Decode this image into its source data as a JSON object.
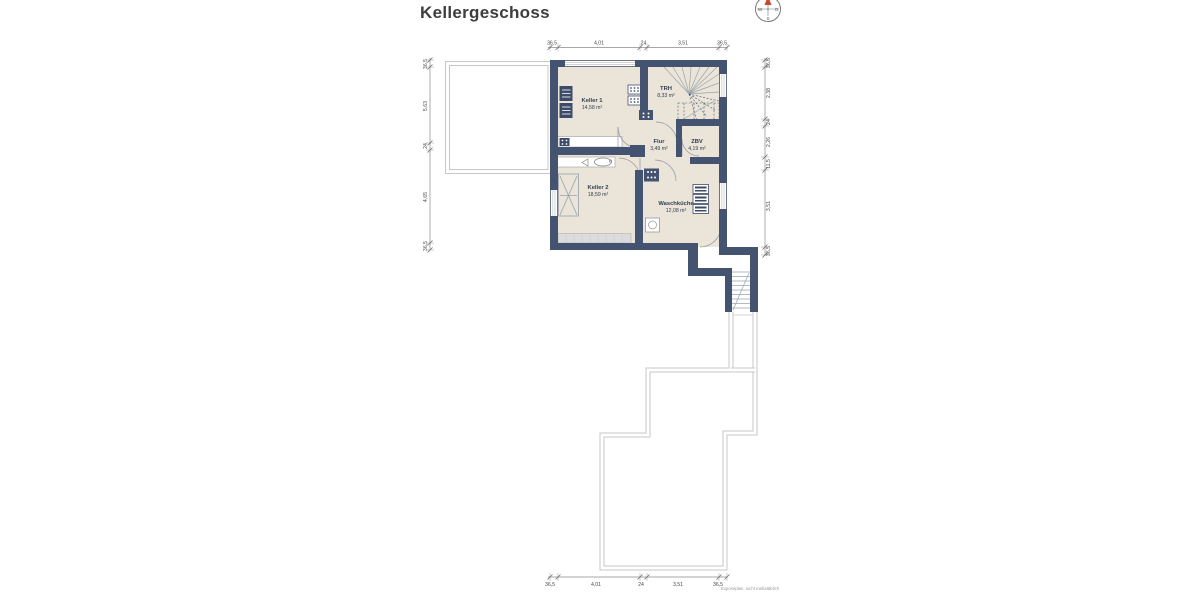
{
  "title": "Kellergeschoss",
  "footer_note": "Exposéplan, nicht maßstäblich",
  "compass": {
    "west": "W",
    "east": "O",
    "south": "S",
    "plus": "+"
  },
  "rooms": [
    {
      "name": "Keller 1",
      "area": "14,58 m²"
    },
    {
      "name": "TRH",
      "area": "8,33 m²"
    },
    {
      "name": "Flur",
      "area": "3,49 m²"
    },
    {
      "name": "ZBV",
      "area": "4,19 m²"
    },
    {
      "name": "Keller 2",
      "area": "18,59 m²"
    },
    {
      "name": "Waschküche",
      "area": "12,08 m²"
    }
  ],
  "dimensions": {
    "top": [
      "36,5",
      "4,01",
      "24",
      "3,51",
      "36,5"
    ],
    "bottom": [
      "36,5",
      "4,01",
      "24",
      "3,51",
      "36,5"
    ],
    "left": [
      "36,5",
      "5,63",
      "24",
      "4,65",
      "36,5"
    ],
    "right": [
      "36,5",
      "2,38",
      "24",
      "2,26",
      "11,5",
      "3,51",
      "36,5"
    ]
  },
  "colors": {
    "wall": "#44536f",
    "floor": "#eae5d8",
    "outline_gray": "#c7c7c7",
    "north_arrow": "#c5492e",
    "furniture_dark": "#3d4b68"
  }
}
